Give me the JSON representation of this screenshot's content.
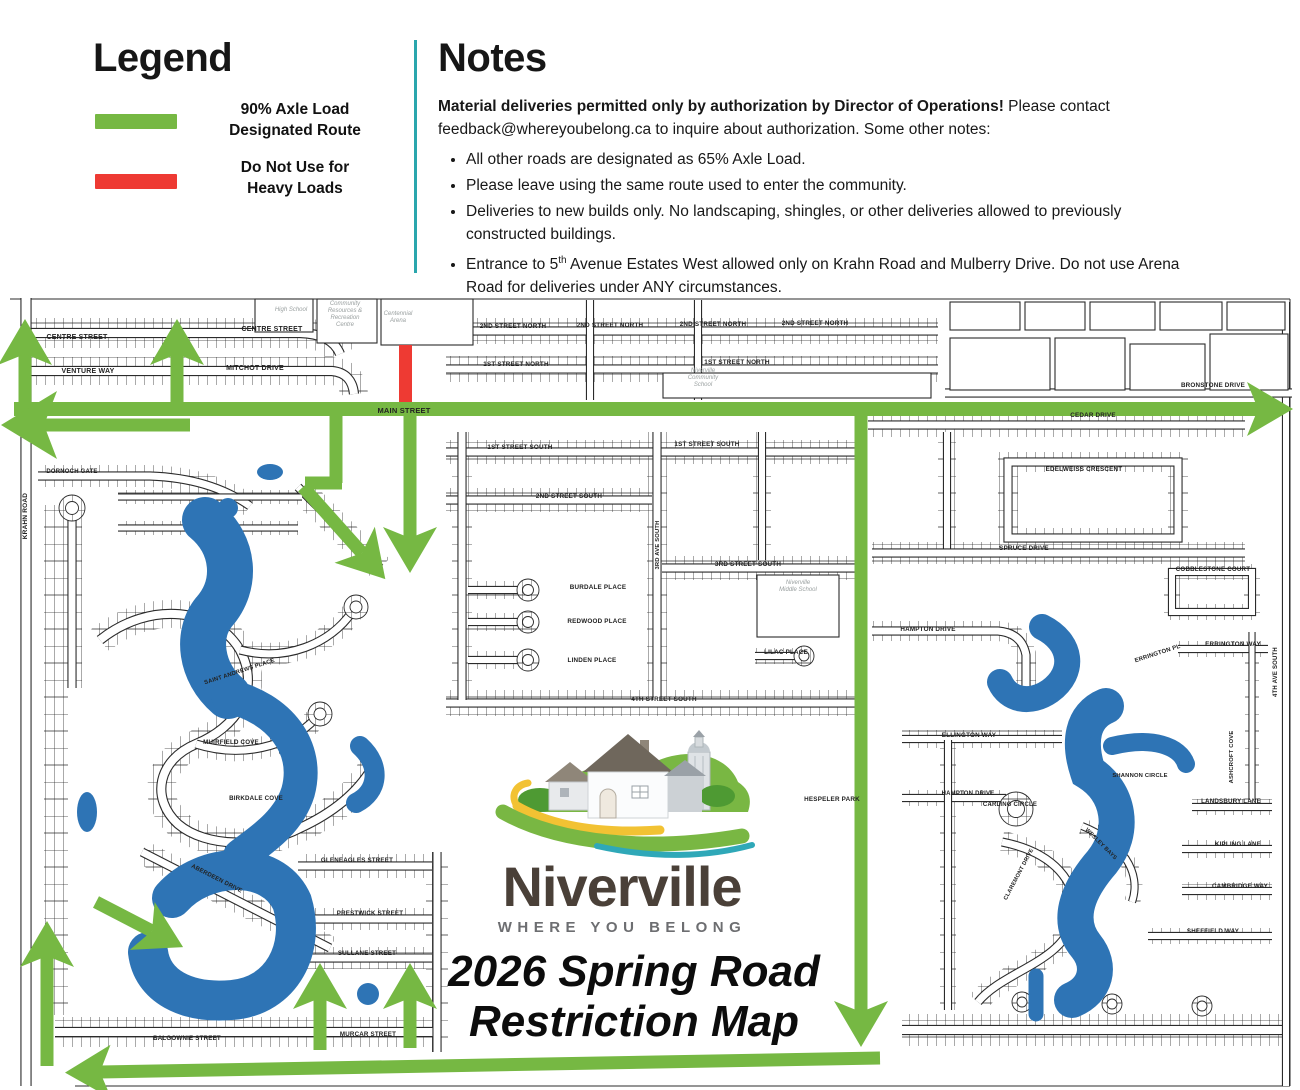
{
  "legend": {
    "title": "Legend",
    "items": [
      {
        "line1": "90% Axle Load",
        "line2": "Designated Route",
        "color": "#76b843"
      },
      {
        "line1": "Do Not Use for",
        "line2": "Heavy Loads",
        "color": "#ee3a33"
      }
    ]
  },
  "notes": {
    "title": "Notes",
    "intro_bold": "Material deliveries permitted only by authorization by Director of Operations!",
    "intro_pre": " Please contact ",
    "email": "feedback@whereyoubelong.ca",
    "intro_post": " to inquire about authorization. Some other notes:",
    "bullets": [
      "All other roads are designated as 65% Axle Load.",
      "Please leave using the same route used to enter the community.",
      "Deliveries to new builds only. No landscaping, shingles, or other deliveries allowed to previously constructed buildings."
    ],
    "bullet4": {
      "pre": "Entrance to 5",
      "sup": "th",
      "post": " Avenue Estates West allowed only on Krahn Road and Mulberry Drive. Do not use Arena Road for deliveries under ANY circumstances."
    }
  },
  "map": {
    "logo": {
      "wordmark": "Niverville",
      "tagline": "WHERE YOU BELONG"
    },
    "title": {
      "line1": "2026 Spring Road",
      "line2": "Restriction Map"
    },
    "colors": {
      "route_green": "#76b843",
      "restricted_red": "#ee3a33",
      "water_blue": "#2e74b5",
      "divider_teal": "#2aa6ad"
    },
    "street_labels": [
      {
        "t": "CENTRE STREET",
        "x": 77,
        "y": 339,
        "s": 7
      },
      {
        "t": "VENTURE WAY",
        "x": 88,
        "y": 373,
        "s": 7
      },
      {
        "t": "CENTRE STREET",
        "x": 272,
        "y": 331,
        "s": 7
      },
      {
        "t": "MITCHOT DRIVE",
        "x": 255,
        "y": 370,
        "s": 7
      },
      {
        "t": "2ND STREET NORTH",
        "x": 513,
        "y": 328,
        "s": 6.3
      },
      {
        "t": "2ND STREET NORTH",
        "x": 610,
        "y": 327,
        "s": 6.3
      },
      {
        "t": "2ND STREET NORTH",
        "x": 713,
        "y": 326,
        "s": 6.3
      },
      {
        "t": "2ND STREET NORTH",
        "x": 815,
        "y": 325,
        "s": 6.3
      },
      {
        "t": "1ST STREET NORTH",
        "x": 516,
        "y": 366,
        "s": 6.3
      },
      {
        "t": "1ST STREET NORTH",
        "x": 737,
        "y": 364,
        "s": 6.3
      },
      {
        "t": "BRONSTONE DRIVE",
        "x": 1213,
        "y": 387,
        "s": 6.3
      },
      {
        "t": "MAIN STREET",
        "x": 404,
        "y": 413,
        "s": 7.5,
        "b": 1
      },
      {
        "t": "CEDAR DRIVE",
        "x": 1093,
        "y": 417,
        "s": 6.3
      },
      {
        "t": "1ST STREET SOUTH",
        "x": 520,
        "y": 449,
        "s": 6.3
      },
      {
        "t": "1ST STREET SOUTH",
        "x": 707,
        "y": 446,
        "s": 6.3
      },
      {
        "t": "2ND STREET SOUTH",
        "x": 569,
        "y": 498,
        "s": 6.3
      },
      {
        "t": "3RD STREET SOUTH",
        "x": 748,
        "y": 566,
        "s": 6.3
      },
      {
        "t": "BURDALE PLACE",
        "x": 598,
        "y": 589,
        "s": 6.3
      },
      {
        "t": "REDWOOD PLACE",
        "x": 597,
        "y": 623,
        "s": 6.3
      },
      {
        "t": "LINDEN PLACE",
        "x": 592,
        "y": 662,
        "s": 6.3
      },
      {
        "t": "LILAC PLACE",
        "x": 786,
        "y": 654,
        "s": 6.3
      },
      {
        "t": "4TH STREET SOUTH",
        "x": 664,
        "y": 701,
        "s": 6.3
      },
      {
        "t": "HESPELER PARK",
        "x": 832,
        "y": 801,
        "s": 6.3
      },
      {
        "t": "EDELWEISS CRESCENT",
        "x": 1084,
        "y": 471,
        "s": 6.3
      },
      {
        "t": "SPRUCE DRIVE",
        "x": 1024,
        "y": 550,
        "s": 6.3
      },
      {
        "t": "COBBLESTONE COURT",
        "x": 1213,
        "y": 571,
        "s": 6.2
      },
      {
        "t": "HAMPTON DRIVE",
        "x": 928,
        "y": 631,
        "s": 6.3
      },
      {
        "t": "ERRINGTON PL",
        "x": 1158,
        "y": 655,
        "s": 6,
        "r": -18
      },
      {
        "t": "ERRINGTON WAY",
        "x": 1233,
        "y": 646,
        "s": 6.3
      },
      {
        "t": "ELLINGTON WAY",
        "x": 969,
        "y": 737,
        "s": 6.3
      },
      {
        "t": "HAMPTON DRIVE",
        "x": 968,
        "y": 795,
        "s": 6
      },
      {
        "t": "CARLING CIRCLE",
        "x": 1010,
        "y": 806,
        "s": 6
      },
      {
        "t": "SHANNON CIRCLE",
        "x": 1140,
        "y": 777,
        "s": 5.8
      },
      {
        "t": "LANDSBURY LANE",
        "x": 1231,
        "y": 803,
        "s": 6.2
      },
      {
        "t": "KIPLING LANE",
        "x": 1238,
        "y": 846,
        "s": 6.2
      },
      {
        "t": "CAMBRIDGE WAY",
        "x": 1240,
        "y": 888,
        "s": 6.2
      },
      {
        "t": "SHEFFIELD WAY",
        "x": 1213,
        "y": 933,
        "s": 6.2
      },
      {
        "t": "ASHCROFT COVE",
        "x": 1233,
        "y": 757,
        "s": 5.8,
        "r": -90
      },
      {
        "t": "4TH AVE SOUTH",
        "x": 1277,
        "y": 672,
        "s": 6,
        "r": -90
      },
      {
        "t": "KRAHN ROAD",
        "x": 27,
        "y": 516,
        "s": 6.5,
        "r": -90
      },
      {
        "t": "3RD AVE SOUTH",
        "x": 659,
        "y": 545,
        "s": 5.8,
        "r": -90
      },
      {
        "t": "DORNOCH GATE",
        "x": 72,
        "y": 473,
        "s": 6
      },
      {
        "t": "SAINT ANDREWS PLACE",
        "x": 240,
        "y": 673,
        "s": 5.8,
        "r": -18
      },
      {
        "t": "MUIRFIELD COVE",
        "x": 231,
        "y": 744,
        "s": 6.2
      },
      {
        "t": "BIRKDALE COVE",
        "x": 256,
        "y": 800,
        "s": 6.2
      },
      {
        "t": "GLENEAGLES STREET",
        "x": 357,
        "y": 862,
        "s": 6.2
      },
      {
        "t": "ABERDEEN DRIVE",
        "x": 216,
        "y": 880,
        "s": 6,
        "r": 27
      },
      {
        "t": "PRESTWICK STREET",
        "x": 370,
        "y": 915,
        "s": 6.2
      },
      {
        "t": "SULLANE STREET",
        "x": 367,
        "y": 955,
        "s": 6.2
      },
      {
        "t": "MURCAR STREET",
        "x": 368,
        "y": 1036,
        "s": 6.2
      },
      {
        "t": "BALGOWNIE STREET",
        "x": 187,
        "y": 1040,
        "s": 6.2
      },
      {
        "t": "WESLEY BAYS",
        "x": 1100,
        "y": 845,
        "s": 5.6,
        "r": 45
      },
      {
        "t": "CLAREMONT DRIVE",
        "x": 1020,
        "y": 875,
        "s": 5.6,
        "r": -62
      }
    ],
    "poi_labels": [
      {
        "t": "High School",
        "x": 291,
        "y": 311
      },
      {
        "t": "Community\nResources &\nRecreation\nCentre",
        "x": 345,
        "y": 305
      },
      {
        "t": "Centennial\nArena",
        "x": 398,
        "y": 315
      },
      {
        "t": "Niverville\nCommunity\nSchool",
        "x": 703,
        "y": 372
      },
      {
        "t": "Niverville\nMiddle School",
        "x": 798,
        "y": 584
      }
    ]
  }
}
